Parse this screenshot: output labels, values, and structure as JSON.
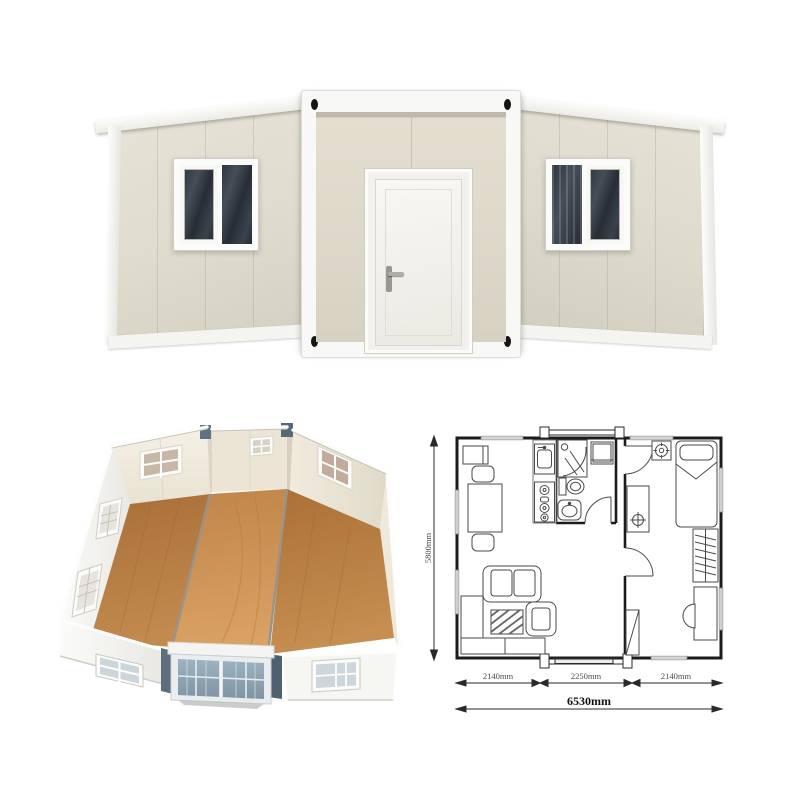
{
  "image": {
    "background": "#ffffff"
  },
  "exterior": {
    "wall_color": "#e0dccd",
    "frame_color": "#f7f7f4",
    "glass_color": "#2b323c",
    "corner_casting_color": "#141414"
  },
  "interior_3d": {
    "floor_wood_dark": "#b5793f",
    "floor_wood_light": "#cf9556",
    "wall_interior_color": "#f2ecdf",
    "wall_exterior_color": "#fafaf8",
    "bay_glass_color": "#8ea4b2",
    "post_color": "#5d6e7c"
  },
  "floorplan": {
    "line_color": "#1b1b1b",
    "furniture_line_color": "#4a4a4a",
    "dims": {
      "height": "5800mm",
      "segments": [
        "2140mm",
        "2250mm",
        "2140mm"
      ],
      "total": "6530mm"
    }
  }
}
